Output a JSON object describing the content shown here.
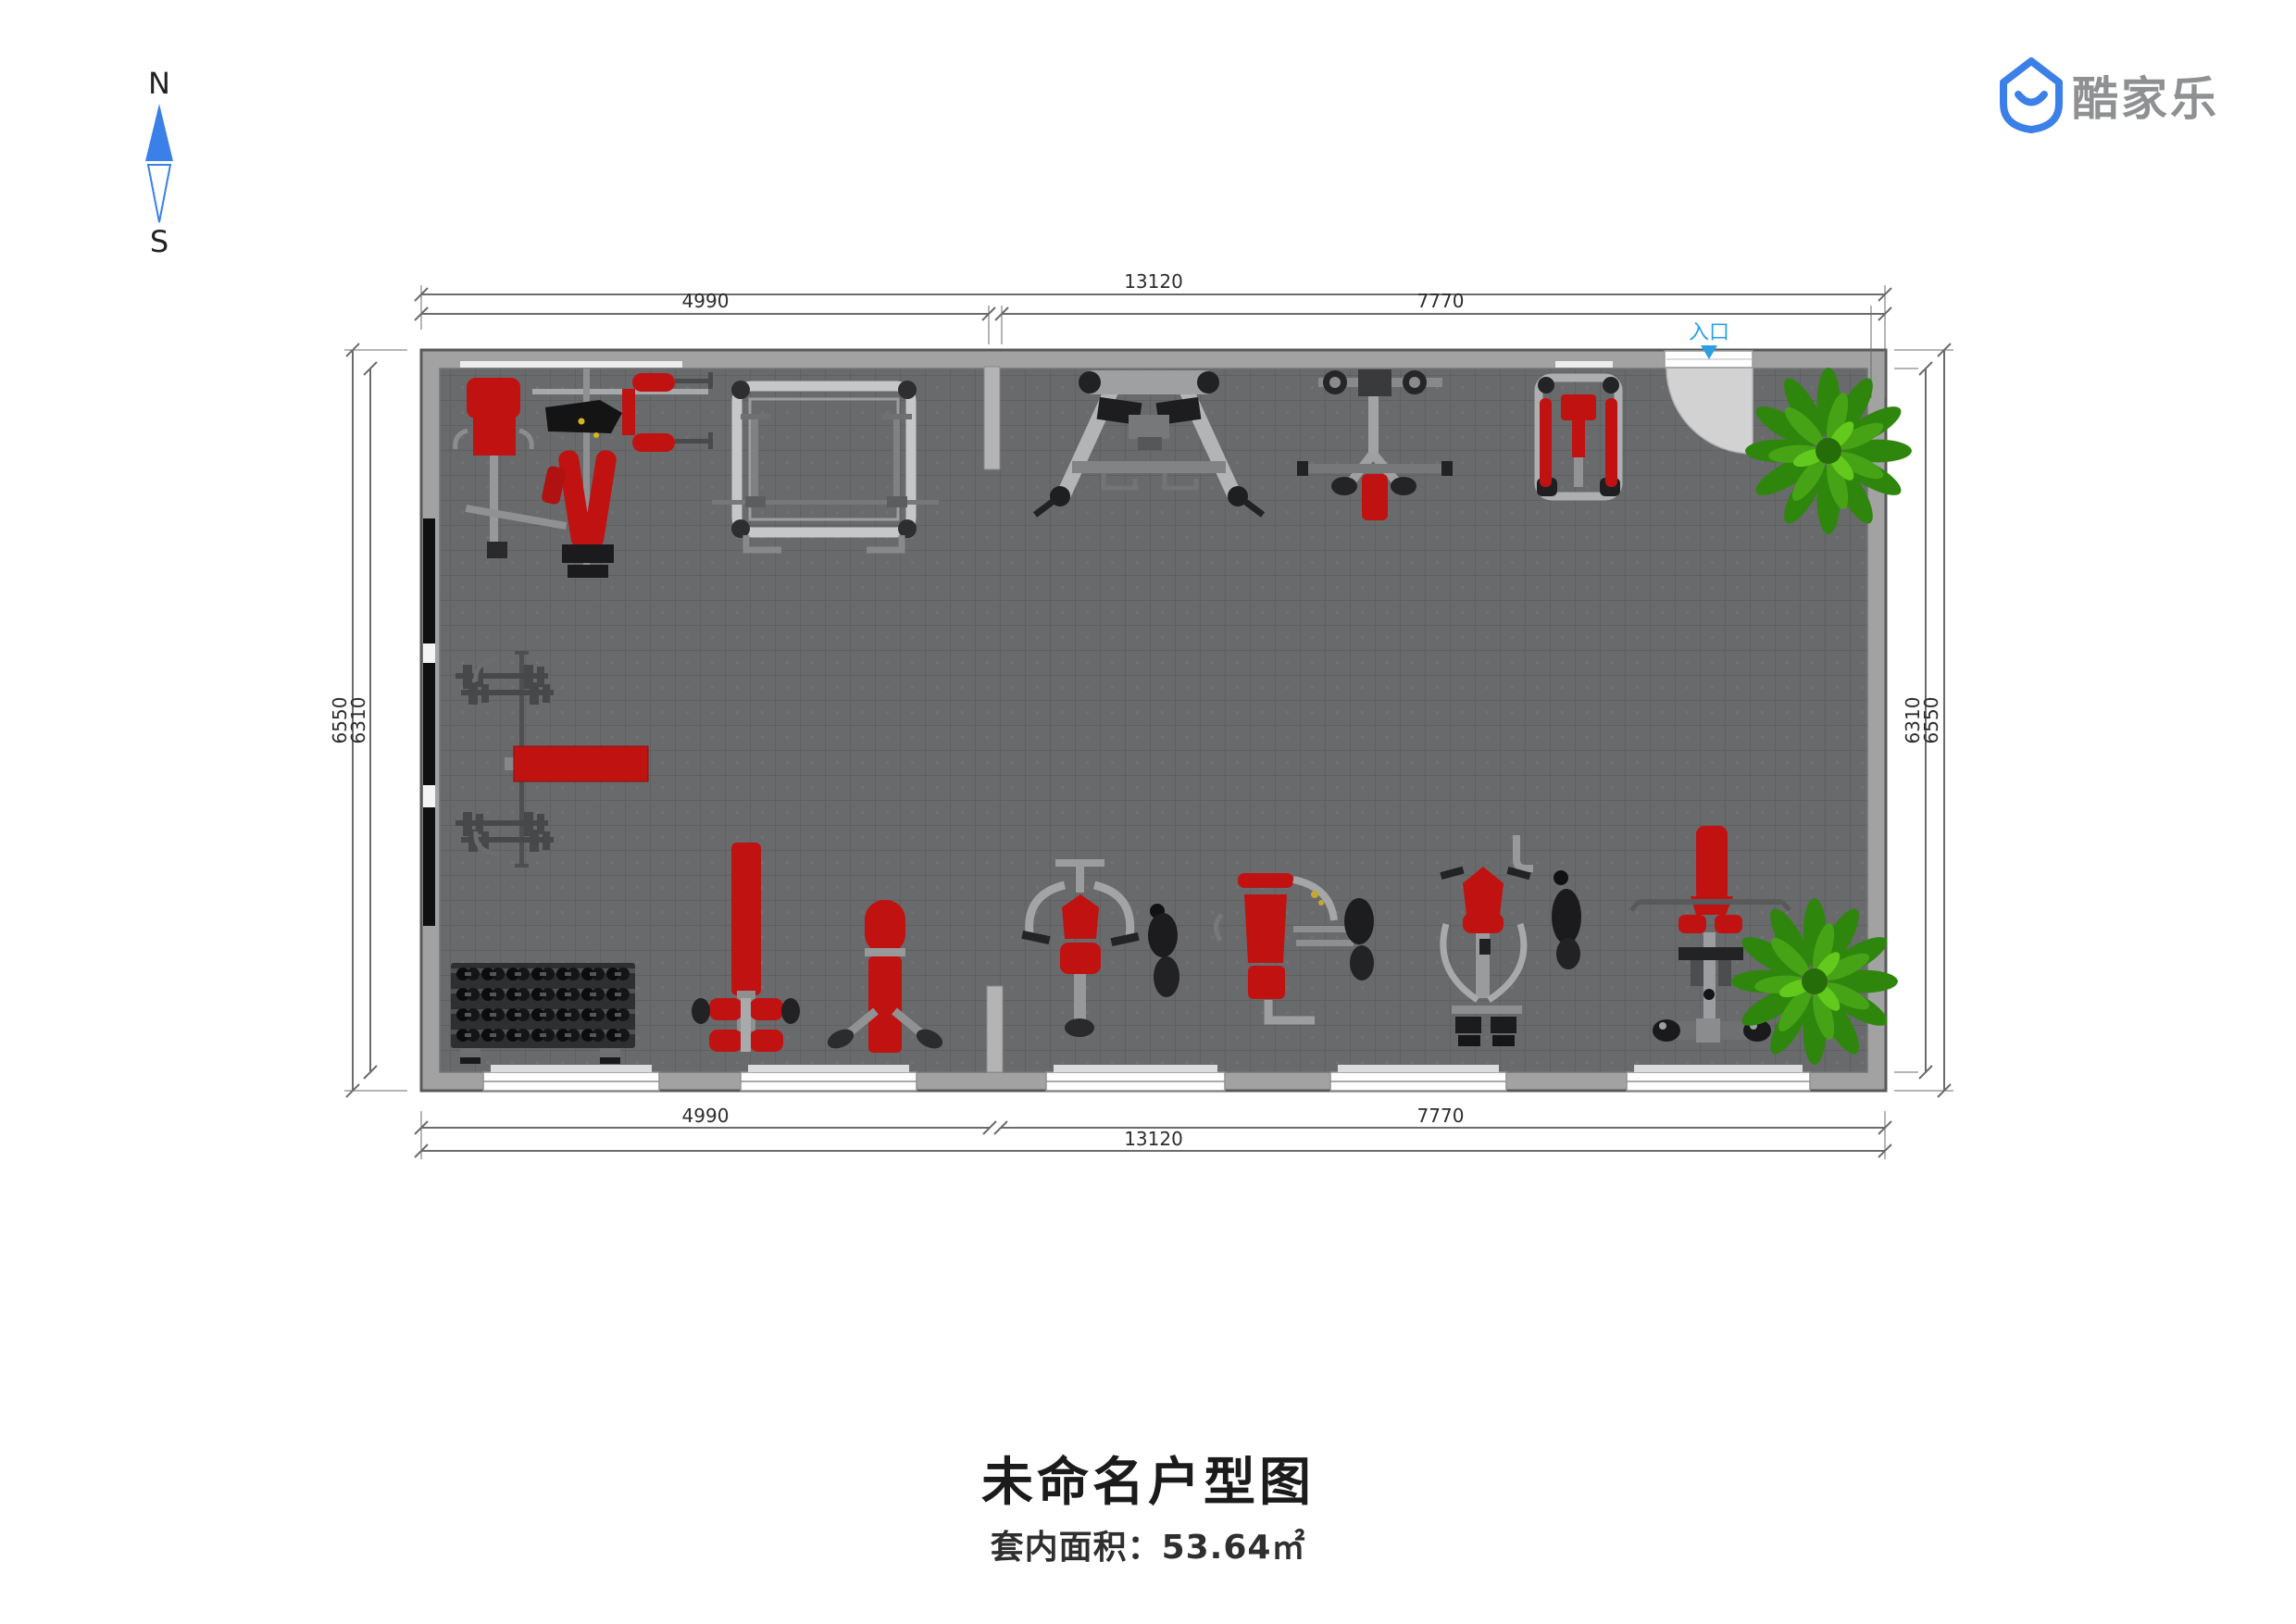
{
  "brand": {
    "name": "酷家乐"
  },
  "compass": {
    "north": "N",
    "south": "S"
  },
  "plan": {
    "entrance_label": "入口",
    "dims": {
      "top_total": "13120",
      "top_left": "4990",
      "top_right": "7770",
      "bottom_left": "4990",
      "bottom_right": "7770",
      "bottom_total": "13120",
      "left_outer": "6550",
      "left_inner": "6310",
      "right_inner": "6310",
      "right_outer": "6550"
    },
    "equipment": [
      "multi-station-gym",
      "power-rack",
      "a-frame-trainer",
      "t-bar-station",
      "dual-pad-station",
      "plant",
      "barbell-with-bench",
      "dumbbell-rack",
      "decline-bench",
      "adjustable-bench",
      "shoulder-press-machine",
      "chest-press-machine",
      "pec-fly-machine",
      "lat-pulldown-machine",
      "plant"
    ],
    "colors": {
      "floor": "#696a6c",
      "wall": "#a2a2a3",
      "mirror": "#0f0f10",
      "equipment_red": "#c11212",
      "plant_green": "#46a315",
      "entrance_blue": "#2b9fe3",
      "brand_blue": "#3b7fe8"
    }
  },
  "footer": {
    "title": "未命名户型图",
    "area": "套内面积：53.64㎡"
  }
}
